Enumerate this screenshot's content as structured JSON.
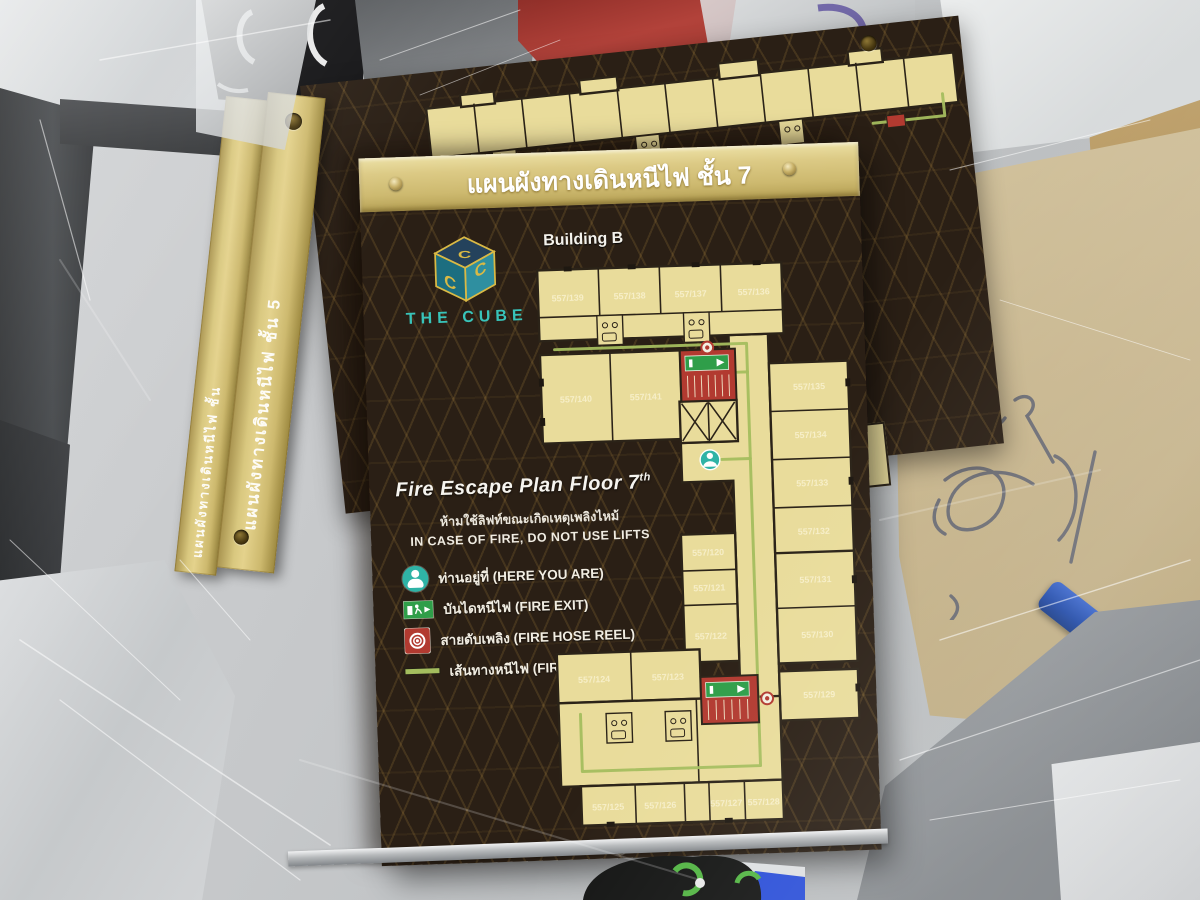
{
  "photo_caption": "Acrylic fire-escape-plan signs stacked on a scratched glass table",
  "colors": {
    "sign_brown": "#2a1f15",
    "gold": "#d8c67f",
    "plan_cream": "#e9dc9b",
    "alert_red": "#b23a30",
    "exit_green": "#2f9e49",
    "route_green": "#a4bd5e",
    "teal": "#2fb3a6",
    "title_text": "#ffffff"
  },
  "sign_stack": {
    "left_bar_text": "แผนผังทางเดินหนีไฟ ชั้น",
    "right_bar_text": "แผนผังทางเดินหนีไฟ ชั้น 5"
  },
  "sign": {
    "title": "แผนผังทางเดินหนีไฟ ชั้น 7",
    "building": "Building B",
    "brand": "THE CUBE",
    "plan_heading": "Fire Escape Plan Floor 7",
    "plan_heading_sup": "th",
    "warning_thai": "ห้ามใช้ลิฟท์ขณะเกิดเหตุเพลิงไหม้",
    "warning_en": "IN CASE OF FIRE, DO NOT USE LIFTS",
    "legend": [
      {
        "icon": "here-you-are-icon",
        "label": "ท่านอยู่ที่ (HERE YOU ARE)"
      },
      {
        "icon": "fire-exit-icon",
        "label": "บันไดหนีไฟ (FIRE EXIT)"
      },
      {
        "icon": "fire-hose-reel-icon",
        "label": "สายดับเพลิง (FIRE HOSE REEL)"
      },
      {
        "icon": "fire-exit-route-icon",
        "label": "เส้นทางหนีไฟ (FIRE EXIT ROUTE)"
      }
    ],
    "rooms": [
      "557/139",
      "557/138",
      "557/137",
      "557/136",
      "557/140",
      "557/141",
      "557/135",
      "557/134",
      "557/133",
      "557/132",
      "557/120",
      "557/121",
      "557/122",
      "557/131",
      "557/130",
      "557/124",
      "557/123",
      "557/129",
      "557/125",
      "557/126",
      "557/127",
      "557/128"
    ]
  }
}
